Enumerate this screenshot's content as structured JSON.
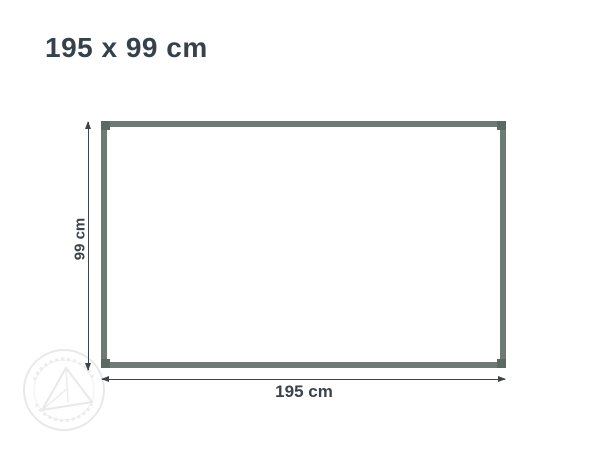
{
  "title": {
    "text": "195 x 99 cm"
  },
  "diagram": {
    "width_label": "195 cm",
    "height_label": "99 cm"
  },
  "theme": {
    "background": "#ffffff",
    "title_color": "#35414b",
    "label_color": "#3a434c",
    "frame_color": "#6d7b74",
    "frame_joint_color": "#5a6961",
    "arrow_color": "#3f4449",
    "watermark_color": "#e9e9e9"
  }
}
